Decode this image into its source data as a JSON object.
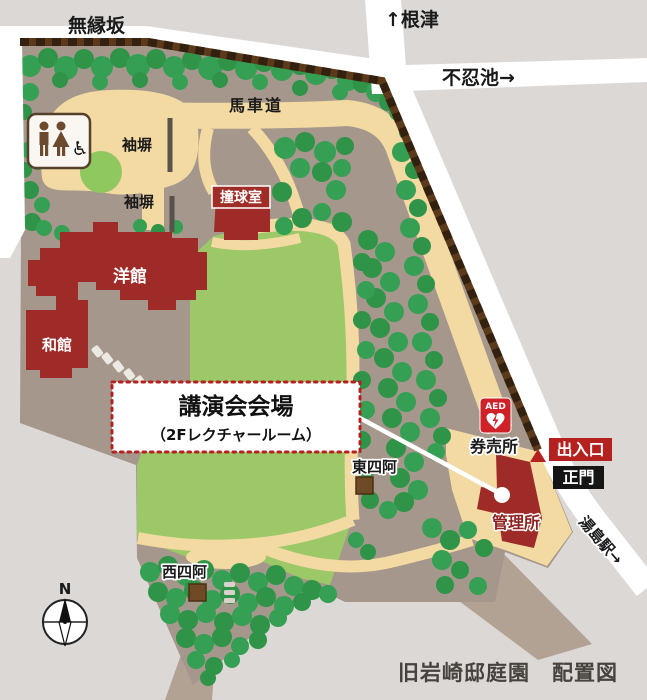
{
  "map": {
    "title": "旧岩崎邸庭園　配置図",
    "labels": {
      "muenzaka": "無縁坂",
      "nezu": "↑根津",
      "shinobazu": "不忍池→",
      "yushima": "湯島駅→",
      "bashamichi": "馬車道",
      "sodebei1": "袖塀",
      "sodebei2": "袖塀",
      "billiard": "撞球室",
      "yokan": "洋館",
      "wakan": "和館",
      "east_arbor": "東四阿",
      "west_arbor": "西四阿",
      "ticket_office": "券売所",
      "admin_office": "管理所",
      "entrance": "出入口",
      "main_gate": "正門",
      "aed": "AED",
      "compass_n": "N"
    },
    "icons": {
      "wheelchair": "♿"
    },
    "callout": {
      "line1": "講演会会場",
      "line2": "（2Fレクチャールーム）"
    },
    "colors": {
      "building_red": "#9e2b28",
      "path_tan": "#f3d9a2",
      "lawn_green": "#9cc868",
      "tree_green": "#35a053",
      "ground_brown": "#a5978b",
      "wall_brown": "#5b3a1c",
      "outside_gray": "#dcd8d6",
      "road_white": "#ffffff",
      "callout_red": "#b5211f",
      "main_gate_black": "#151515",
      "aed_red": "#cf2128"
    }
  }
}
